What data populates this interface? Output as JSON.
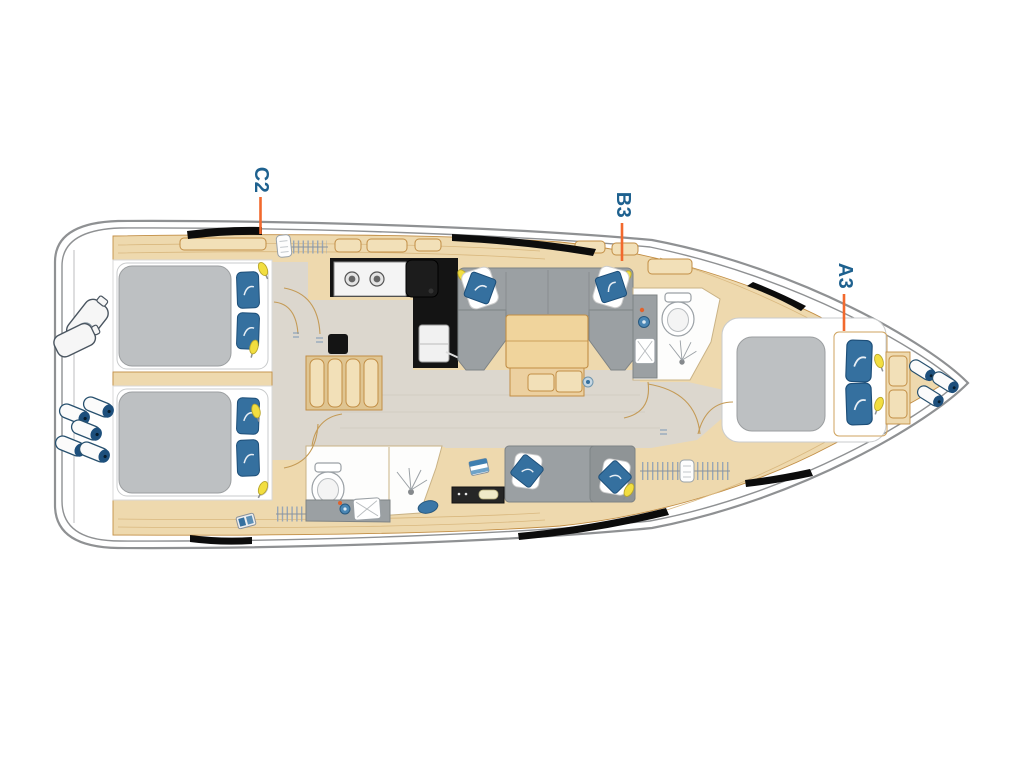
{
  "diagram": {
    "type": "yacht-interior-floor-plan",
    "cabin_labels": [
      {
        "id": "C2"
      },
      {
        "id": "B3"
      },
      {
        "id": "A3"
      }
    ],
    "colors": {
      "label_text": "#1e618f",
      "leader_line": "#f2692d",
      "hull_outline": "#8f9193",
      "wood": "#eed9ae",
      "wood_trim": "#c28e45",
      "floor": "#dcd7ce",
      "upholstery_gray": "#9ba0a3",
      "mattress_gray": "#bdc0c2",
      "pillow_blue": "#35709f",
      "galley_black": "#141414",
      "reading_light_yellow": "#f2de40",
      "fender_blue": "#1d4f7c"
    }
  }
}
